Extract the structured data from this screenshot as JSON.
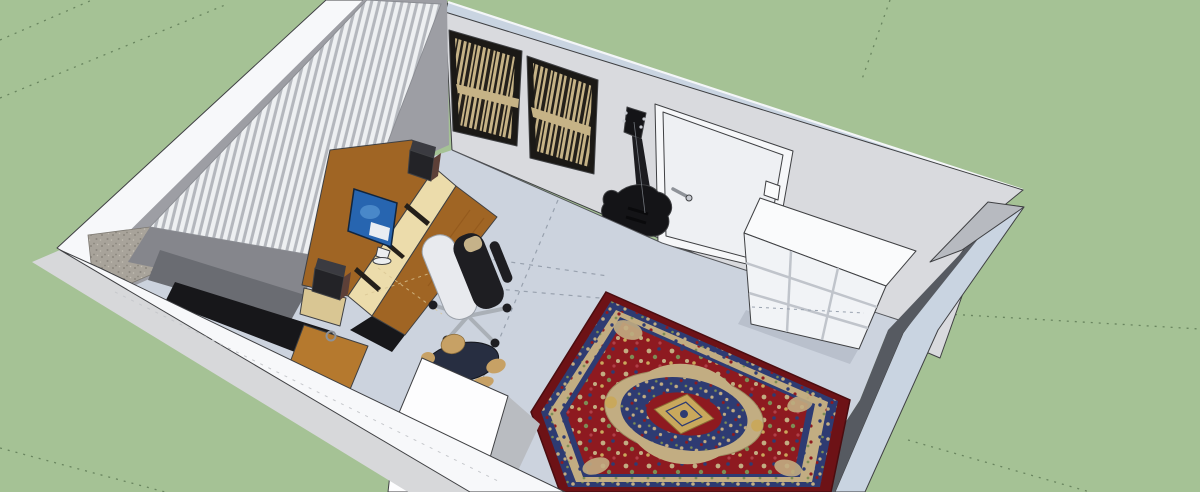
{
  "viewport": {
    "app_label": "3d-model-viewport",
    "description": "SketchUp-style 3D view of a home studio room seen from above: ribbed diffuser wall, slatted acoustic panels, wall-mounted bass guitar, door, white cube shelf, wooden desk with monitor riser and studio speakers, office chair, seated figure and a red oriental rug",
    "width": 1200,
    "height": 492
  },
  "objects": {
    "room": "studio room shell with section-cut front walls",
    "ribbed_wall": "corrugated diffuser panel on left wall",
    "acoustic_panel_left": "slatted acoustic diffuser panel",
    "acoustic_panel_right": "slatted acoustic diffuser panel",
    "bass_guitar": "black bass guitar hung on back wall",
    "door": "white interior door with lever handle",
    "cube_shelf": "white 3x3 cube storage shelf",
    "rug": "red oriental rug with navy border and central medallion",
    "desk": "wooden studio desk with monitor riser and cream compartments",
    "drawer_cabinet": "wooden drawer cabinet with ring pull",
    "monitor": "computer monitor with blue desktop screen",
    "speaker_left": "black studio monitor speaker",
    "speaker_right": "black studio monitor speaker",
    "chair": "office swivel chair, white shell with black pads",
    "person": "seated figure in dark blue shirt",
    "concrete_patch": "textured cut face at west corner",
    "ground": "green modeling ground plane with dashed guide lines"
  },
  "colors": {
    "background": "#a5c295",
    "ground_line": "#69855f",
    "white": "#ffffff",
    "wall_white": "#f7f8fa",
    "wall_outer_gray": "#d7d8da",
    "wall_top_band": "#c9d4e1",
    "wall_top_white": "#f4f6f8",
    "wall_face": "#d9dade",
    "wall_corner_wedge": "#c9cacd",
    "wall_inner_gray": "#9d9ea4",
    "wall_inner_mid": "#85868c",
    "wall_inner_dark": "#6a6c72",
    "wall_cut_face": "#b7bac0",
    "wall_dark_face": "#565a61",
    "front_panel_white": "#fdfdfe",
    "front_panel_side": "#b9bcc1",
    "shadow_black": "#17171a",
    "concrete": "#a8a39a",
    "concrete_dot": "#8b867e",
    "concrete_dot2": "#c2bdb2",
    "rib_light": "#eef0f2",
    "rib_shadow": "#b4b7bd",
    "floor": "#ccd3de",
    "floor_seam": "#98a1ae",
    "floor_shadow": "#b9c0cc",
    "edge": "#3f4043",
    "panel_frame": "#1b1916",
    "panel_slat": "#c6b386",
    "panel_stripe": "#24201a",
    "door_frame": "#f6f7f9",
    "door_leaf": "#eef0f3",
    "door_handle": "#8e9298",
    "guitar_black": "#141417",
    "guitar_neck": "#1c1c20",
    "guitar_string": "#9aa0a8",
    "metal_light": "#c9ccd2",
    "desk_wood": "#a06524",
    "desk_wood_light": "#b5792e",
    "desk_wood_grain": "#8a5117",
    "desk_cream": "#ecdcab",
    "desk_leg": "#d9c693",
    "divider_dark": "#241f19",
    "speaker_black": "#232327",
    "speaker_top": "#3b3b41",
    "speaker_brown": "#5d4038",
    "screen_blue": "#2765b0",
    "screen_glow": "#4e8ccc",
    "screen_white": "#e9edf2",
    "monitor_stand": "#eceef0",
    "chair_black": "#1e1e22",
    "chair_shell": "#e8eaee",
    "chair_shell_edge": "#9aa0a8",
    "chair_metal": "#aab0b7",
    "chair_tan": "#c5b289",
    "person_shirt": "#272e41",
    "person_skin": "#c7a165",
    "person_skin_edge": "#8a6c3c",
    "shelf_white": "#fafbfc",
    "shelf_cube": "#f1f3f6",
    "shelf_line": "#c0c4cb",
    "rug_edge_dark": "#4a0d10",
    "rug_border": "#6d1216",
    "rug_navy": "#2e3b72",
    "rug_cream": "#c2ad82",
    "rug_cream_edge": "#9c8a60",
    "rug_red": "#8e1a20",
    "rug_red_light": "#b04048",
    "rug_tan": "#c9a85c",
    "rug_tan_edge": "#8a6c34",
    "rug_green": "#7d8d55"
  }
}
